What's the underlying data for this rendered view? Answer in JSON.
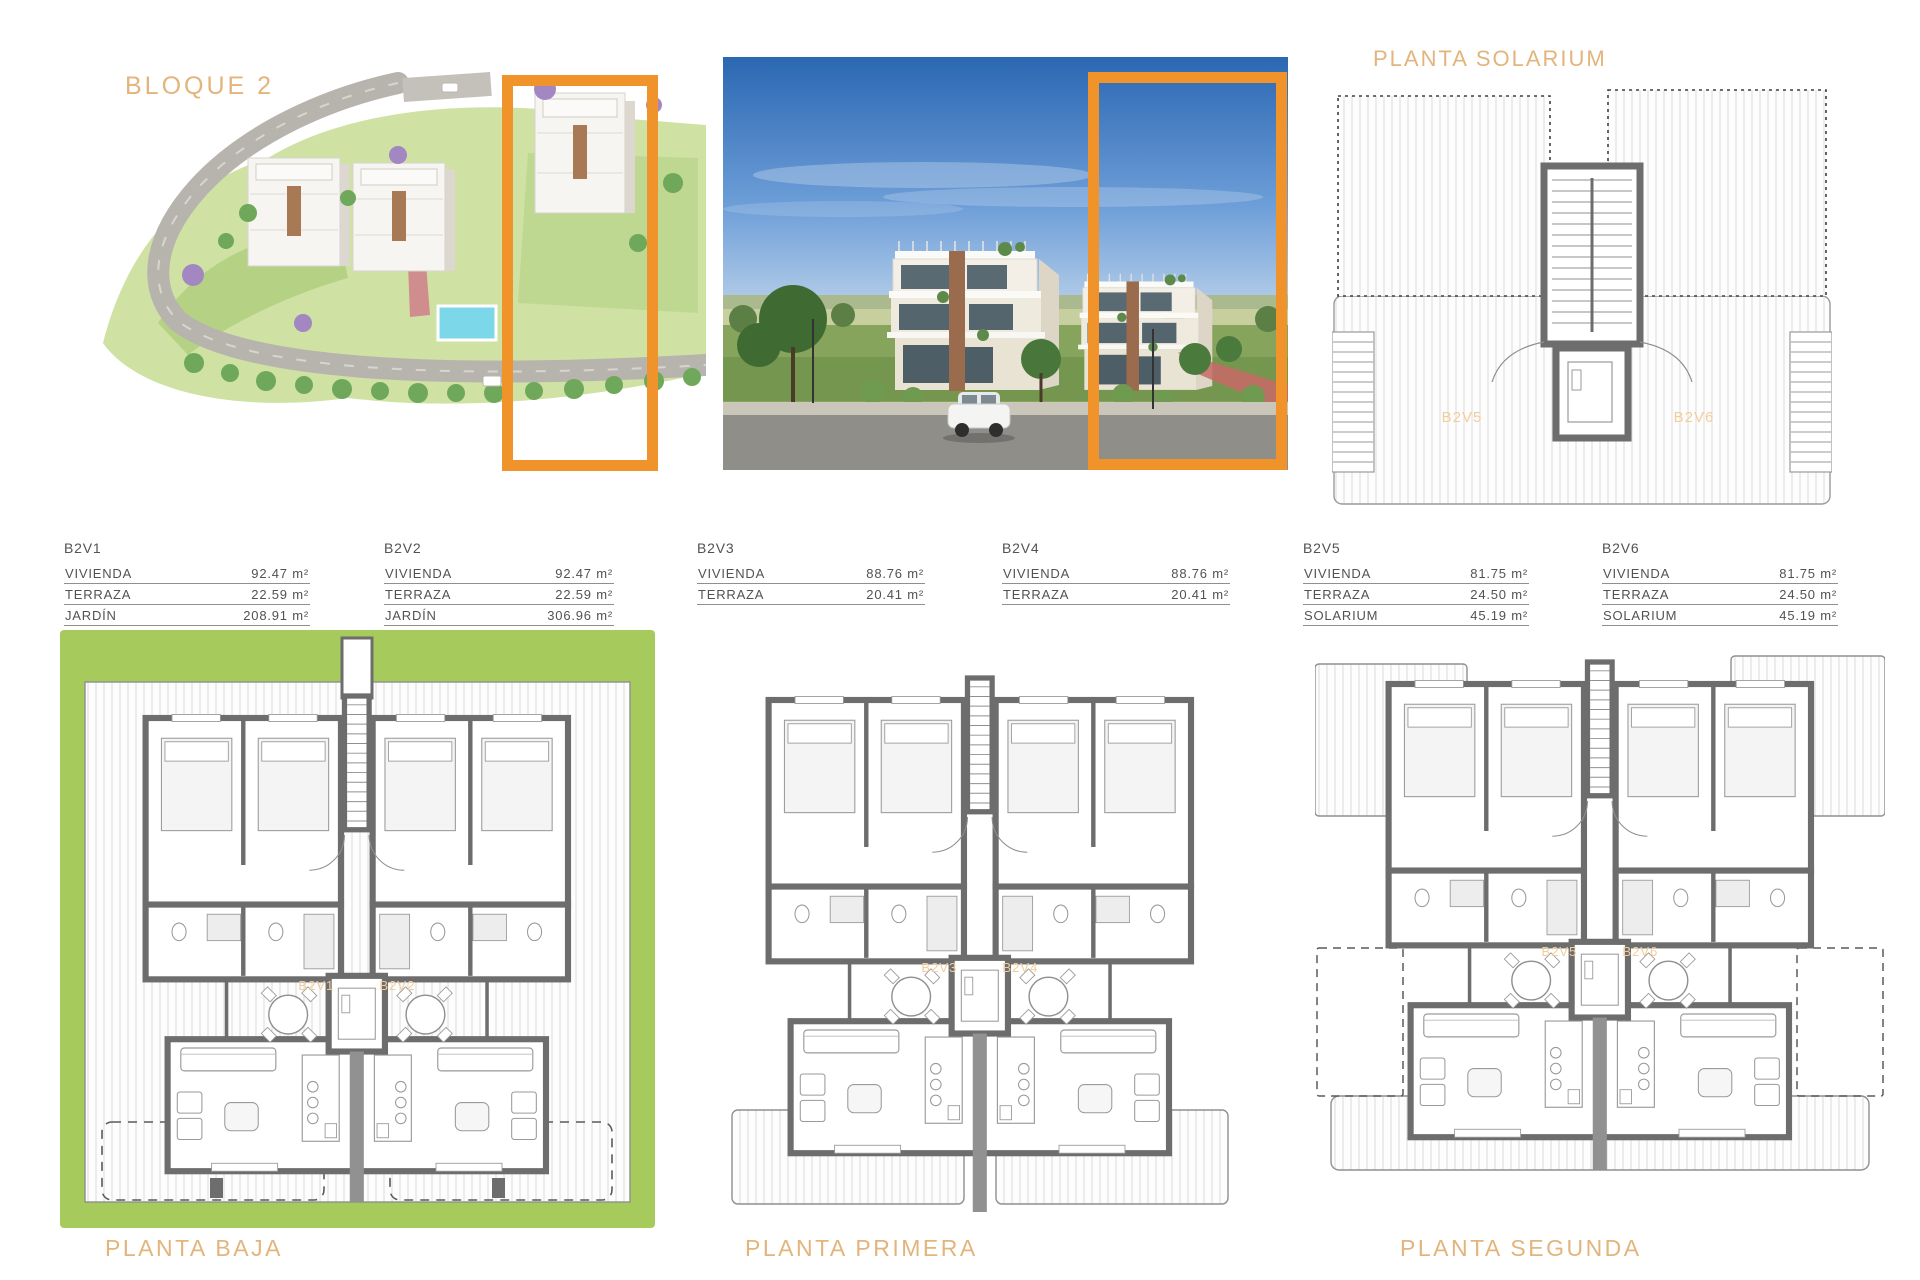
{
  "document": {
    "block_title": "BLOQUE 2",
    "solarium_title": "PLANTA SOLARIUM",
    "accent_color": "#F0932B",
    "heading_color": "#E3B47C"
  },
  "unit_tables": [
    {
      "unit": "B2V1",
      "rows": [
        {
          "label": "VIVIENDA",
          "value": "92.47 m²"
        },
        {
          "label": "TERRAZA",
          "value": "22.59 m²"
        },
        {
          "label": "JARDÍN",
          "value": "208.91 m²"
        }
      ]
    },
    {
      "unit": "B2V2",
      "rows": [
        {
          "label": "VIVIENDA",
          "value": "92.47 m²"
        },
        {
          "label": "TERRAZA",
          "value": "22.59 m²"
        },
        {
          "label": "JARDÍN",
          "value": "306.96 m²"
        }
      ]
    },
    {
      "unit": "B2V3",
      "rows": [
        {
          "label": "VIVIENDA",
          "value": "88.76 m²"
        },
        {
          "label": "TERRAZA",
          "value": "20.41 m²"
        }
      ]
    },
    {
      "unit": "B2V4",
      "rows": [
        {
          "label": "VIVIENDA",
          "value": "88.76 m²"
        },
        {
          "label": "TERRAZA",
          "value": "20.41 m²"
        }
      ]
    },
    {
      "unit": "B2V5",
      "rows": [
        {
          "label": "VIVIENDA",
          "value": "81.75 m²"
        },
        {
          "label": "TERRAZA",
          "value": "24.50 m²"
        },
        {
          "label": "SOLARIUM",
          "value": "45.19 m²"
        }
      ]
    },
    {
      "unit": "B2V6",
      "rows": [
        {
          "label": "VIVIENDA",
          "value": "81.75 m²"
        },
        {
          "label": "TERRAZA",
          "value": "24.50 m²"
        },
        {
          "label": "SOLARIUM",
          "value": "45.19 m²"
        }
      ]
    }
  ],
  "floor_plans": [
    {
      "label": "PLANTA BAJA",
      "unit_labels": [
        "B2V1",
        "B2V2"
      ]
    },
    {
      "label": "PLANTA PRIMERA",
      "unit_labels": [
        "B2V3",
        "B2V4"
      ]
    },
    {
      "label": "PLANTA SEGUNDA",
      "unit_labels": [
        "B2V5",
        "B2V6"
      ]
    },
    {
      "label": "PLANTA SOLARIUM",
      "unit_labels": [
        "B2V5",
        "B2V6"
      ]
    }
  ]
}
